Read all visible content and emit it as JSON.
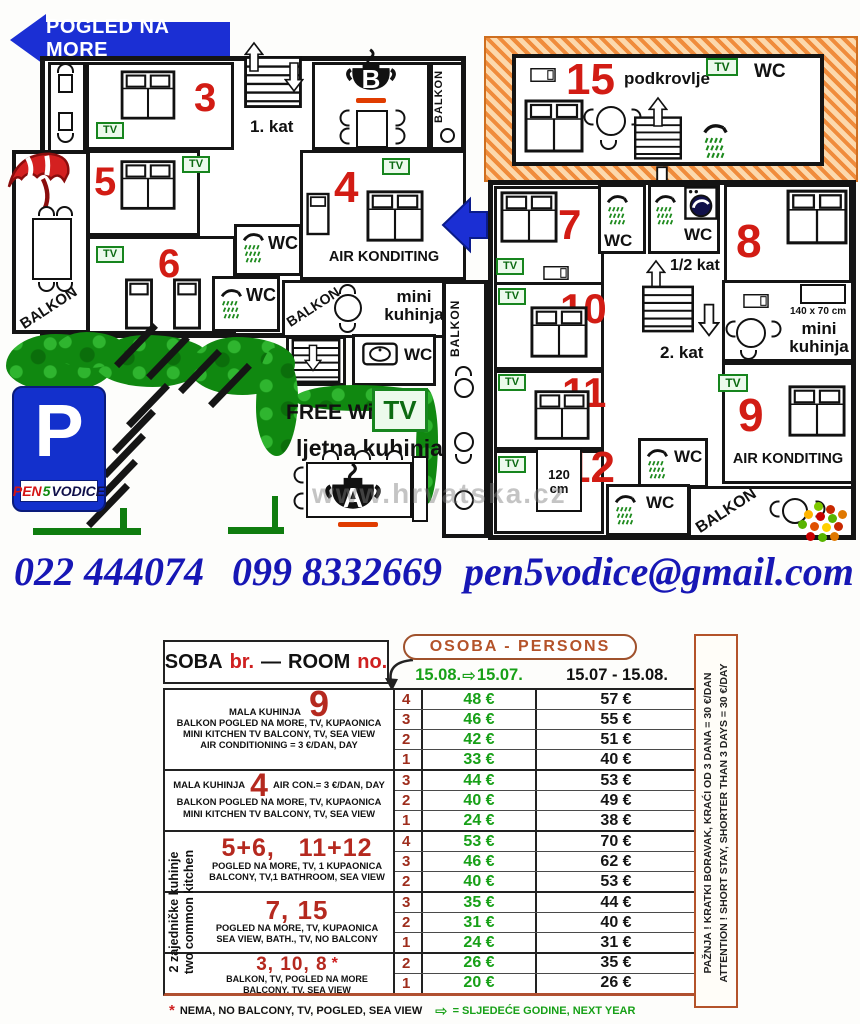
{
  "plan": {
    "banner": "POGLED NA MORE",
    "rooms": {
      "r3": "3",
      "r4": "4",
      "r5": "5",
      "r6": "6",
      "r7": "7",
      "r8": "8",
      "r9": "9",
      "r10": "10",
      "r11": "11",
      "r12": "12",
      "r15": "15"
    },
    "labels": {
      "tv": "TV",
      "wc": "WC",
      "balkon": "BALKON",
      "kat1": "1. kat",
      "kat_half": "1/2 kat",
      "kat2": "2. kat",
      "podkrovlje": "podkrovlje",
      "mini_kuhinja": "mini kuhinja",
      "air": "AIR KONDITING",
      "free_wifi": "FREE Wi - Fi",
      "ljetna": "ljetna kuhinja",
      "bed140": "140 x 70 cm",
      "bed120": "120 cm",
      "kitchen_a": "A",
      "kitchen_b": "B",
      "parking_p": "P",
      "pen": "PEN",
      "five": "5",
      "vodice": "VODICE",
      "watermark": "www.hrvatska.cz"
    }
  },
  "contact": {
    "phone1": "022 444074",
    "phone2": "099 8332669",
    "email": "pen5vodice@gmail.com"
  },
  "table": {
    "room_header": {
      "soba": "SOBA",
      "br": "br.",
      "dash": "—",
      "room": "ROOM",
      "no": "no."
    },
    "persons_header": "OSOBA - PERSONS",
    "arrow": "⇨",
    "date_green": {
      "from": "15.08.",
      "to": "15.07."
    },
    "date_black": "15.07 - 15.08.",
    "blocks": [
      {
        "number": "9",
        "prefix": "MALA KUHINJA",
        "suffix": "",
        "desc1": "BALKON POGLED NA MORE, TV, KUPAONICA",
        "desc2": "MINI KITCHEN  TV  BALCONY, TV,  SEA VIEW",
        "desc3": "AIR CONDITIONING = 3 €/DAN, DAY",
        "rows": [
          {
            "p": "4",
            "g": "48 €",
            "b": "57 €"
          },
          {
            "p": "3",
            "g": "46 €",
            "b": "55 €"
          },
          {
            "p": "2",
            "g": "42 €",
            "b": "51 €"
          },
          {
            "p": "1",
            "g": "33 €",
            "b": "40 €"
          }
        ]
      },
      {
        "number": "4",
        "prefix": "MALA KUHINJA",
        "suffix": "AIR CON.= 3 €/DAN, DAY",
        "desc1": "BALKON POGLED NA MORE, TV, KUPAONICA",
        "desc2": "MINI KITCHEN  TV  BALCONY, TV,  SEA VIEW",
        "rows": [
          {
            "p": "3",
            "g": "44 €",
            "b": "53 €"
          },
          {
            "p": "2",
            "g": "40 €",
            "b": "49 €"
          },
          {
            "p": "1",
            "g": "24 €",
            "b": "38 €"
          }
        ]
      },
      {
        "number": "5+6,   11+12",
        "desc1": "POGLED NA MORE, TV, 1 KUPAONICA",
        "desc2": "BALCONY, TV,1 BATHROOM, SEA VIEW",
        "rows": [
          {
            "p": "4",
            "g": "53 €",
            "b": "70 €"
          },
          {
            "p": "3",
            "g": "46 €",
            "b": "62 €"
          },
          {
            "p": "2",
            "g": "40 €",
            "b": "53 €"
          }
        ]
      },
      {
        "number": "7, 15",
        "desc1": "POGLED NA MORE, TV, KUPAONICA",
        "desc2": "SEA VIEW, BATH., TV, NO BALCONY",
        "rows": [
          {
            "p": "3",
            "g": "35 €",
            "b": "44 €"
          },
          {
            "p": "2",
            "g": "31 €",
            "b": "40 €"
          },
          {
            "p": "1",
            "g": "24 €",
            "b": "31 €"
          }
        ]
      },
      {
        "number": "3, 10, 8",
        "star": "*",
        "desc1": "BALKON, TV,  POGLED  NA  MORE",
        "desc2": "BALCONY, TV,  SEA VIEW",
        "rows": [
          {
            "p": "2",
            "g": "26 €",
            "b": "35 €"
          },
          {
            "p": "1",
            "g": "20 €",
            "b": "26 €"
          }
        ]
      }
    ],
    "left_vertical1": "2 zajedničke kuhinje",
    "left_vertical2": "two common kitchen",
    "side_note1": "PAŽNJA !  KRATKI BORAVAK, KRAĆI OD 3 DANA  =  30 €/DAN",
    "side_note2": "ATTENTION ! SHORT STAY, SHORTER THAN  3 DAYS = 30 €/DAY",
    "foot_star": "*",
    "footnote": "NEMA, NO BALCONY, TV, POGLED, SEA VIEW",
    "legend": "=  SLJEDEĆE GODINE,  NEXT YEAR"
  }
}
